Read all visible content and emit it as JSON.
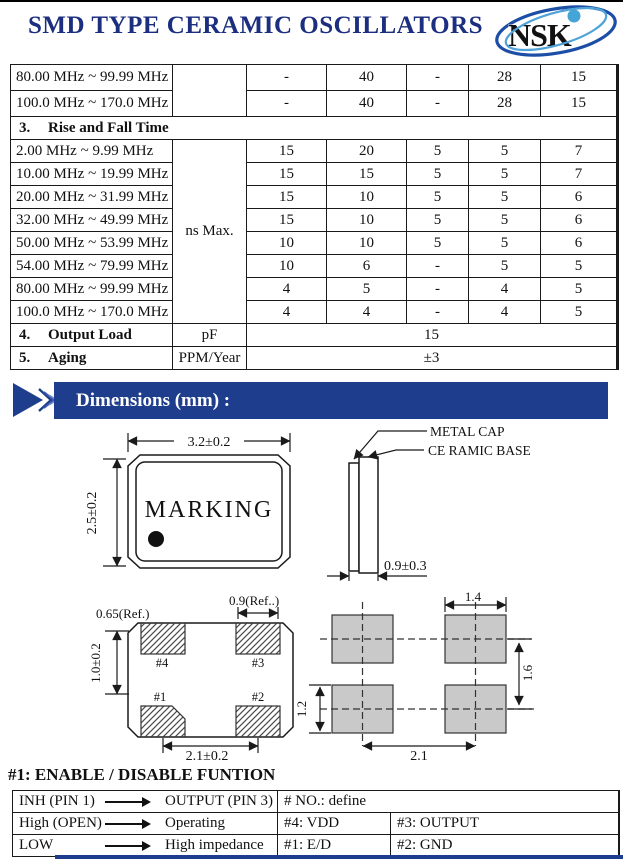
{
  "header": {
    "title": "SMD TYPE CERAMIC OSCILLATORS",
    "logo_text": "NSK",
    "title_color": "#1c2e7f",
    "banner_color": "#1e3d8d",
    "logo_navy": "#15298f",
    "logo_light_blue": "#45a5d6"
  },
  "spec_table": {
    "top_rows": [
      {
        "label": "80.00 MHz ~ 99.99 MHz",
        "values": [
          "-",
          "40",
          "-",
          "28",
          "15"
        ]
      },
      {
        "label": "100.0 MHz ~ 170.0 MHz",
        "values": [
          "-",
          "40",
          "-",
          "28",
          "15"
        ]
      }
    ],
    "section3": {
      "num": "3.",
      "text": "Rise and Fall Time"
    },
    "unit_merged": "ns Max.",
    "rise_rows": [
      {
        "label": "2.00 MHz ~ 9.99 MHz",
        "values": [
          "15",
          "20",
          "5",
          "5",
          "7"
        ]
      },
      {
        "label": "10.00 MHz ~ 19.99 MHz",
        "values": [
          "15",
          "15",
          "5",
          "5",
          "7"
        ]
      },
      {
        "label": "20.00 MHz ~ 31.99 MHz",
        "values": [
          "15",
          "10",
          "5",
          "5",
          "6"
        ]
      },
      {
        "label": "32.00 MHz ~ 49.99 MHz",
        "values": [
          "15",
          "10",
          "5",
          "5",
          "6"
        ]
      },
      {
        "label": "50.00 MHz ~ 53.99 MHz",
        "values": [
          "10",
          "10",
          "5",
          "5",
          "6"
        ]
      },
      {
        "label": "54.00 MHz ~ 79.99 MHz",
        "values": [
          "10",
          "6",
          "-",
          "5",
          "5"
        ]
      },
      {
        "label": "80.00 MHz ~ 99.99 MHz",
        "values": [
          "4",
          "5",
          "-",
          "4",
          "5"
        ]
      },
      {
        "label": "100.0 MHz ~ 170.0 MHz",
        "values": [
          "4",
          "4",
          "-",
          "4",
          "5"
        ]
      }
    ],
    "output_load": {
      "num": "4.",
      "text": "Output Load",
      "unit": "pF",
      "value": "15"
    },
    "aging": {
      "num": "5.",
      "text": "Aging",
      "unit": "PPM/Year",
      "value": "±3"
    }
  },
  "dimensions_banner": {
    "label": "Dimensions (mm) :"
  },
  "drawings": {
    "marking_label": "MARKING",
    "metal_cap_label": "METAL CAP",
    "ceramic_base_label": "CE RAMIC BASE",
    "body_width": "3.2±0.2",
    "body_height": "2.5±0.2",
    "thickness": "0.9±0.3",
    "pad_offset_ref": "0.65(Ref.)",
    "pad_width_ref": "0.9(Ref..)",
    "pad_row_dim": "1.0±0.2",
    "pad_pitch": "2.1±0.2",
    "pin1": "#1",
    "pin2": "#2",
    "pin3": "#3",
    "pin4": "#4",
    "land_width": "1.4",
    "land_height": "1.2",
    "land_vpitch": "1.6",
    "land_hpitch": "2.1"
  },
  "enable_table": {
    "title": "#1: ENABLE / DISABLE FUNTION",
    "rows": [
      {
        "from": "INH (PIN 1)",
        "to": "OUTPUT (PIN 3)",
        "c2": "# NO.: define"
      },
      {
        "from": "High (OPEN)",
        "to": "Operating",
        "c2": "#4: VDD",
        "c3": "#3: OUTPUT"
      },
      {
        "from": "LOW",
        "to": "High impedance",
        "c2": "#1: E/D",
        "c3": "#2: GND"
      }
    ]
  }
}
